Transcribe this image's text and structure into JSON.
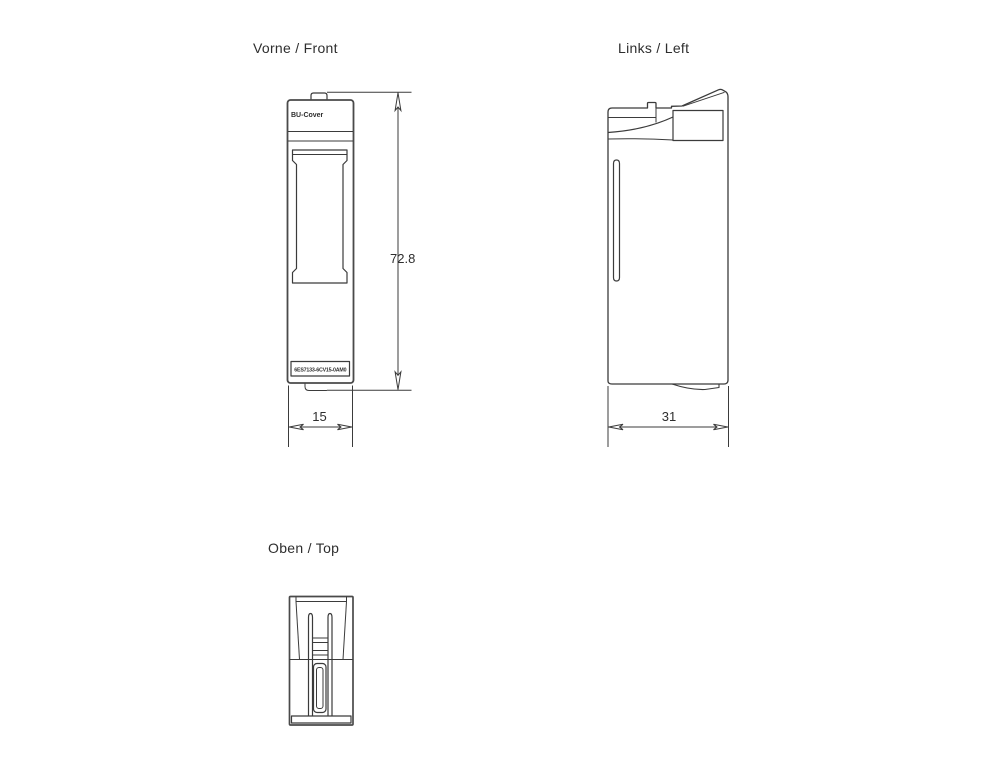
{
  "drawing": {
    "views": {
      "front": {
        "title": "Vorne / Front",
        "cover_label": "BU-Cover",
        "part_number": "6ES7133-6CV15-0AM0",
        "height_dim": "72.8",
        "width_dim": "15"
      },
      "left": {
        "title": "Links / Left",
        "depth_dim": "31"
      },
      "top": {
        "title": "Oben / Top"
      }
    },
    "colors": {
      "line": "#3b3b3b",
      "text": "#2e2e2e",
      "background": "#ffffff"
    }
  }
}
